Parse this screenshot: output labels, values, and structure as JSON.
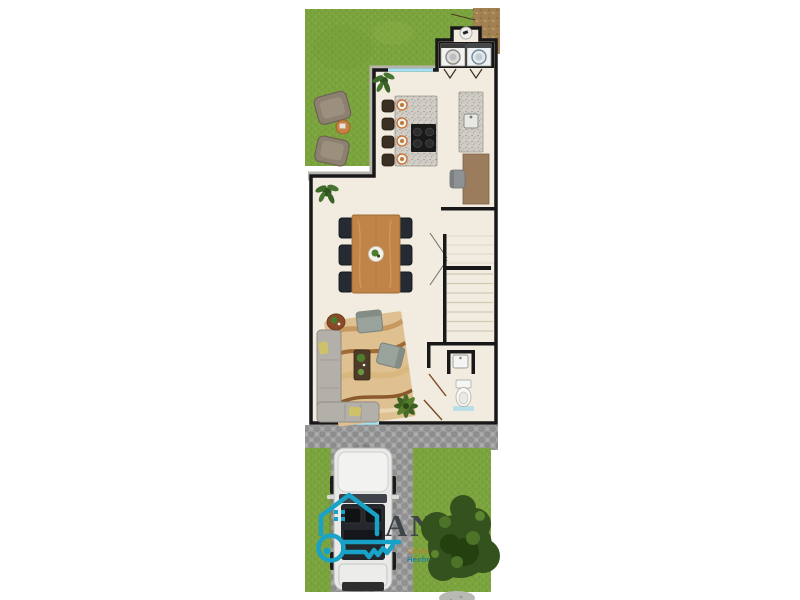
{
  "watermark": {
    "brand": "ANEX",
    "tagline_line1": "Casas y Sueños",
    "tagline_line2": "Hechos Realidad"
  },
  "palette": {
    "accent": "#18a2c8",
    "brand_text": "#3f4448",
    "tagline1": "#b9873a",
    "tagline2": "#1d7f9c",
    "grass": "#7ca43e",
    "tree": "#33521d",
    "cobble": "#9e9e9e",
    "floor": "#f1ecdf",
    "wall": "#181818",
    "exterior_wall": "#b7b4ad",
    "window": "#a6e1ef",
    "wood": "#c08449",
    "granite": "#cfccc5",
    "rug": "#dfc191",
    "dark_chair": "#262b33",
    "sofa": "#b3b0a9",
    "car_body": "#e9e9e7",
    "dirt_path": "#a28253"
  }
}
